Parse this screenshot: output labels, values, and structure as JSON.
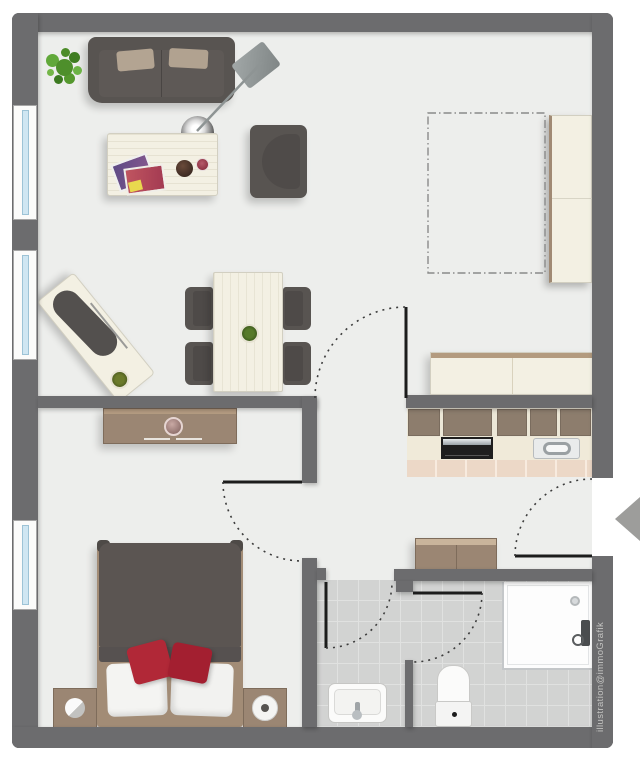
{
  "watermark": {
    "text": "illustration@immoGrafik"
  },
  "plan": {
    "type": "apartment-floor-plan",
    "style": "top-down furnished illustration",
    "outer_walls_px": {
      "left": 12,
      "top": 13,
      "right": 613,
      "bottom": 748,
      "thickness": 20
    },
    "window_count": 3,
    "door_count": 5,
    "entrance": {
      "side": "right",
      "marker": "gray left-pointing triangle arrow"
    }
  },
  "palette": {
    "wall": "#6c6c6e",
    "floor": "#edeeec",
    "bath_tile": "#d2d3d2",
    "kitchen_tile": "#ecd8c7",
    "wood": "#9b8673",
    "upholstery_dark": "#585451",
    "furniture_cream": "#f3f0e3",
    "pillow_beige": "#b3a492",
    "cushion_red": "#b12837",
    "plant_green": "#54992f",
    "window_glass": "#cfe6f2",
    "arrow_gray": "#9d9d9b",
    "door_leaf": "#1c1c1c",
    "door_arc": "#3c3c3c"
  },
  "rooms": {
    "living_room": {
      "position": "top-left",
      "items": [
        "sofa",
        "sofa-pillows",
        "potted-plant",
        "arc-floor-lamp",
        "coffee-table",
        "magazines",
        "bowl",
        "wine-glass",
        "armchair",
        "desk",
        "office-chair",
        "desk-plant",
        "dining-table",
        "table-plant",
        "dining-chairs x4"
      ],
      "windows": 2
    },
    "sleep_alcove_top_right": {
      "position": "top-right",
      "items": [
        "wardrobe",
        "dashed-bed-outline"
      ]
    },
    "kitchen": {
      "position": "middle-right",
      "items": [
        "sideboard-living-side",
        "wall-cabinets x5",
        "stove",
        "sink",
        "tiled-floor-strip"
      ]
    },
    "hallway": {
      "position": "center",
      "items": [
        "cabinet",
        "entrance-door",
        "entrance-arrow"
      ]
    },
    "bedroom": {
      "position": "bottom-left",
      "items": [
        "double-bed",
        "white-pillows x2",
        "red-cushions x2",
        "nightstand-left",
        "nightstand-lamp-left",
        "nightstand-right",
        "nightstand-lamp-right",
        "sideboard",
        "vase"
      ],
      "windows": 1
    },
    "bathroom": {
      "position": "bottom-right",
      "items": [
        "wash-basin",
        "toilet",
        "shower",
        "partition-wall",
        "inner-door"
      ],
      "floor": "gray tiles"
    }
  }
}
